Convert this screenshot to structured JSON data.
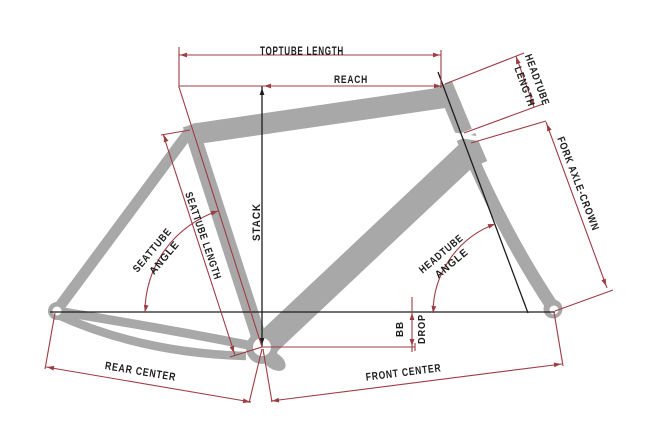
{
  "diagram": {
    "type": "bicycle-frame-geometry",
    "labels": {
      "toptube_length": "TOPTUBE LENGTH",
      "reach": "REACH",
      "headtube_length_line1": "HEADTUBE",
      "headtube_length_line2": "LENGTH",
      "fork_axle_crown": "FORK AXLE-CROWN",
      "stack": "STACK",
      "seattube_length": "SEATTUBE LENGTH",
      "seattube_angle_line1": "SEATTUBE",
      "seattube_angle_line2": "ANGLE",
      "headtube_angle_line1": "HEADTUBE",
      "headtube_angle_line2": "ANGLE",
      "bb_drop_line1": "BB",
      "bb_drop_line2": "DROP",
      "rear_center": "REAR CENTER",
      "front_center": "FRONT CENTER"
    },
    "colors": {
      "dimension_line": "#9d3c42",
      "label_text": "#1c1c1c",
      "frame_fill": "#a8a8a8",
      "axis_line": "#1c1c1c",
      "background": "#ffffff"
    }
  }
}
